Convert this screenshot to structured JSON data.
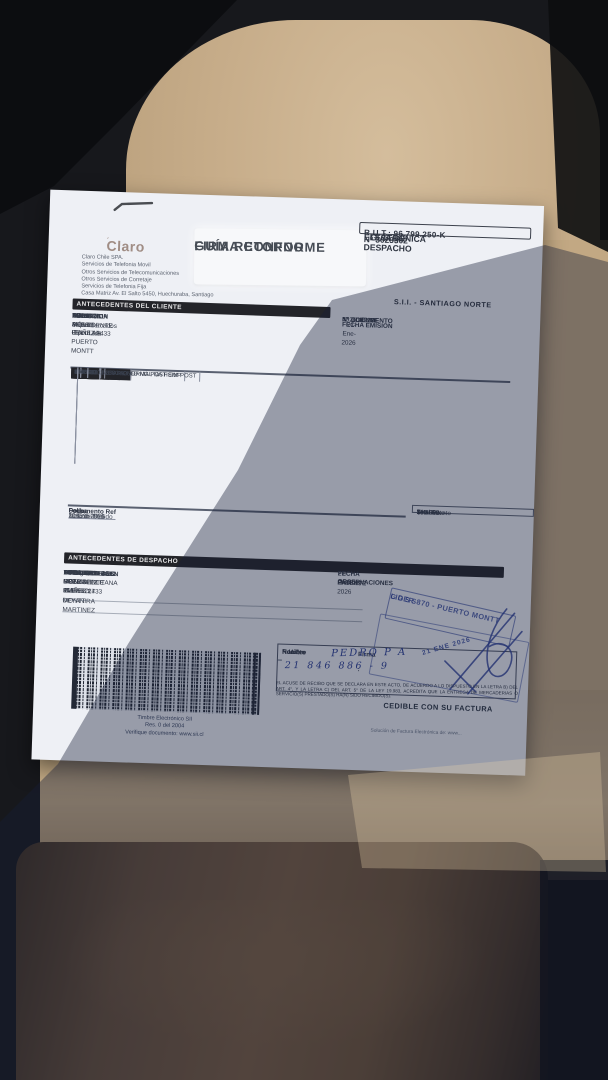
{
  "colors": {
    "ink_blue": "#2b3f97",
    "header_bar": "#232429",
    "paper": "#eef0f5",
    "seat_beige": "#c7ad8a",
    "jacket_brown": "#6e5339"
  },
  "punct": {
    "colon": ":"
  },
  "vendor": {
    "logo": "Claro",
    "company_lines": [
      "Claro Chile SPA.",
      "Servicios de Telefonia Movil",
      "Otros Servicios de Telecomunicaciones",
      "Otros Servicios de Corretaje",
      "Servicios de Telefonia Fija",
      "Casa Matriz Av. El Salto 5450, Huechuraba, Santiago"
    ]
  },
  "return_label": {
    "line1": "GUÍA RETORNO",
    "line2": "FIRMA CONFORME"
  },
  "rut_box": {
    "rut": "R.U.T.: 96.799.250-K",
    "type1": "GUÍA DE DESPACHO",
    "type2": "ELECTRÓNICA",
    "number": "Nº 3023302",
    "sii": "S.I.I. - SANTIAGO NORTE"
  },
  "cliente": {
    "title": "ANTECEDENTES DEL CLIENTE",
    "rows": [
      {
        "label": "NOMBRE",
        "value": "AD. de Supermercados Hiper Ltda."
      },
      {
        "label": "DIRECCION",
        "value": "AV PRESIDENTE IBAÑEZ 1433"
      },
      {
        "label": "",
        "value": "PUERTO MONTT -  PUERTO MONTT"
      },
      {
        "label": "R.U.T.",
        "value": "76.134.941-4"
      },
      {
        "label": "GIRO",
        "value": "TELEFONIA MÓVIL CELULAR"
      }
    ],
    "refs": [
      {
        "label": "Nº CLIENTE",
        "value": "4026189281"
      },
      {
        "label": "Nº DOCUMENTO",
        "value": ""
      },
      {
        "label": "FECHA EMISION",
        "value": "21-Ene-2026"
      }
    ]
  },
  "items_table": {
    "headers": [
      "CANTIDAD",
      "CODIGO",
      "DESCRIPCION",
      "PRECIO UNITARIO",
      "MONTO"
    ],
    "rows": [
      [
        "1",
        "70014897",
        "SMG GA26128GA266D NG POST EMP",
        "189.832",
        "189.832"
      ],
      [
        "1",
        "7005701",
        "4FF GX.02 256 KB NORMAL NA HSIM POST",
        "840",
        "840"
      ]
    ]
  },
  "ref_table": {
    "headers": [
      "Documento Ref",
      "Folio",
      "Fecha"
    ],
    "row": [
      "Nota de Pedido",
      "1083957551",
      "21 Ene 2026"
    ]
  },
  "totals": {
    "currency": "$",
    "rows": [
      {
        "label": "Total Neto",
        "value": "190.672"
      },
      {
        "label": "19% IVA",
        "value": "36.228"
      },
      {
        "label": "Total Exento",
        "value": ""
      },
      {
        "label": "Total",
        "value": "226.900"
      }
    ]
  },
  "despacho": {
    "title": "ANTECEDENTES DE DESPACHO",
    "rows": [
      {
        "label": "BODEGA ORIGEN",
        "value": "LO BOZA 441"
      },
      {
        "label": "",
        "value": "PUDAHUEL  METROPOLITANA"
      },
      {
        "label": "TIPO TRASLADO",
        "value": "Consignaciones"
      },
      {
        "label": "CONTACTO DES.",
        "value": "DAMARY GONZALEZ 953498227 DEYANIRA MARTINEZ"
      },
      {
        "label": "DIRECCION DES.",
        "value": "932398500"
      },
      {
        "label": "",
        "value": "AV PRESIDENTE IBAÑEZ 1433"
      },
      {
        "label": "",
        "value": "PUERTO MONTT   PUERTO MONTT"
      }
    ],
    "refs": [
      {
        "label": "FECHA",
        "value": "21-Ene-2026"
      },
      {
        "label": "PATENTE",
        "value": "HHJK63"
      },
      {
        "label": "OBSERVACIONES",
        "value": ""
      }
    ]
  },
  "dealer_stamp": {
    "line1": "LIDER 870 - PUERTO MONTT",
    "line2": "GGSS"
  },
  "barcode": {
    "caption1": "Timbre Electrónico SII",
    "caption2": "Res. 0 del 2004",
    "caption3": "Verifique documento: www.sii.cl"
  },
  "recibo": {
    "labels": [
      "Nombre",
      "R.U.T",
      "Recinto"
    ],
    "firma_label": "Firma :",
    "handwritten_name": "PEDRO P A",
    "handwritten_rut": "21 846 886 - 9",
    "date_stamp": "21 ENE 2026"
  },
  "legal_text": "EL ACUSE DE RECIBO QUE SE DECLARA EN ESTE ACTO, DE ACUERDO A LO DISPUESTO EN LA LETRA B) DEL ART. 4°, Y LA LETRA C) DEL ART. 5° DE LA LEY 19.983, ACREDITA QUE LA ENTREGA DE MERCADERIAS O SERVICIO(S) PRESTADO(S) HA(N) SIDO RECIBIDO(S).",
  "cedible_label": "CEDIBLE CON SU FACTURA",
  "footer_note": "Solución de Factura Electrónica de: www..."
}
